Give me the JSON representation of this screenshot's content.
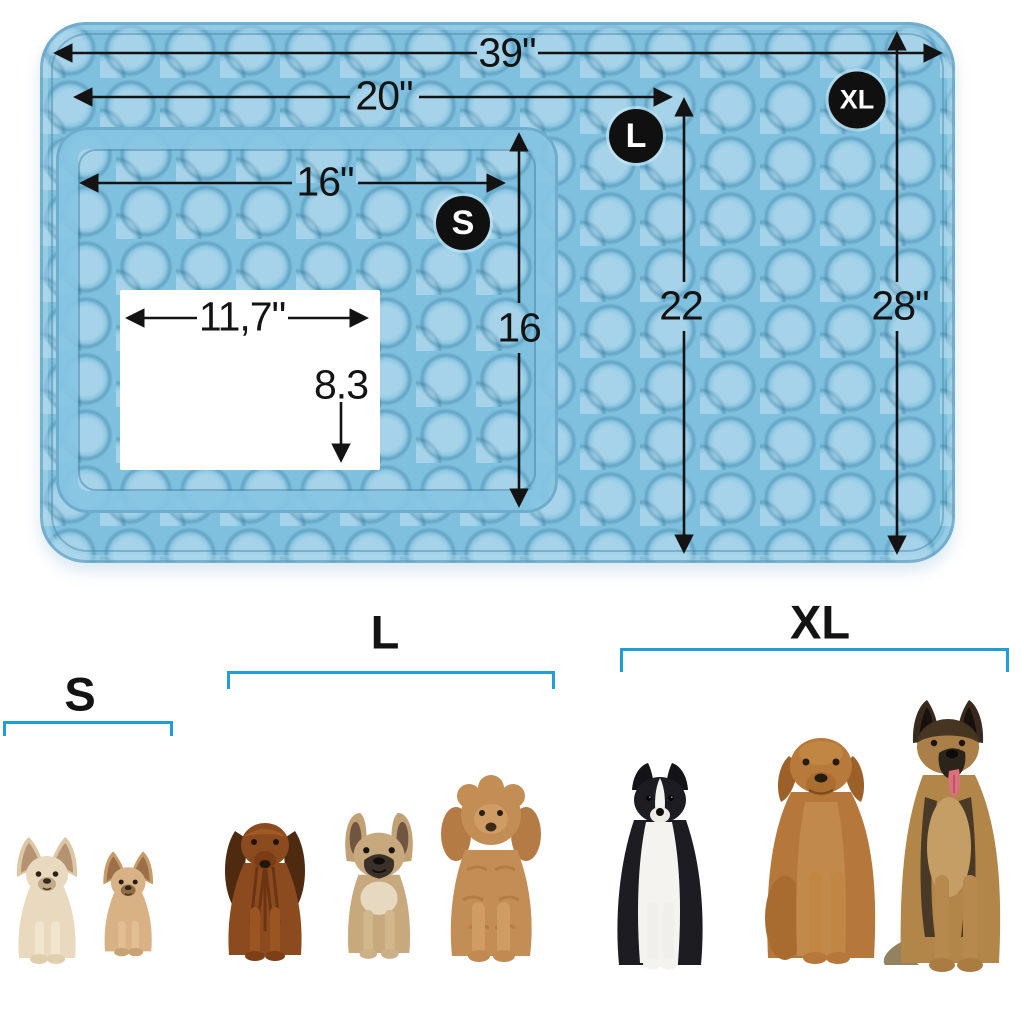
{
  "colors": {
    "mat_blue": "#7fc0df",
    "mat_seam_blue": "#5f9fc2",
    "bracket_blue": "#1f9ed9",
    "dimension_line": "#131313",
    "badge_background": "#101010",
    "badge_text": "#ffffff",
    "paper_white": "#ffffff"
  },
  "diagram": {
    "badges": {
      "s": "S",
      "l": "L",
      "xl": "XL"
    },
    "dimensions": {
      "xl_width": "39\"",
      "l_width": "20\"",
      "s_width": "16\"",
      "s_height": "16",
      "l_height": "22",
      "xl_height": "28\"",
      "paper_width": "11,7\"",
      "paper_height": "8.3"
    }
  },
  "size_guide": {
    "groups": [
      {
        "id": "s",
        "label": "S",
        "dogs": [
          "cream chihuahua",
          "tan chihuahua"
        ]
      },
      {
        "id": "l",
        "label": "L",
        "dogs": [
          "long-haired dachshund",
          "french bulldog",
          "apricot poodle"
        ]
      },
      {
        "id": "xl",
        "label": "XL",
        "dogs": [
          "border collie",
          "labrador retriever",
          "german shepherd"
        ]
      }
    ]
  }
}
